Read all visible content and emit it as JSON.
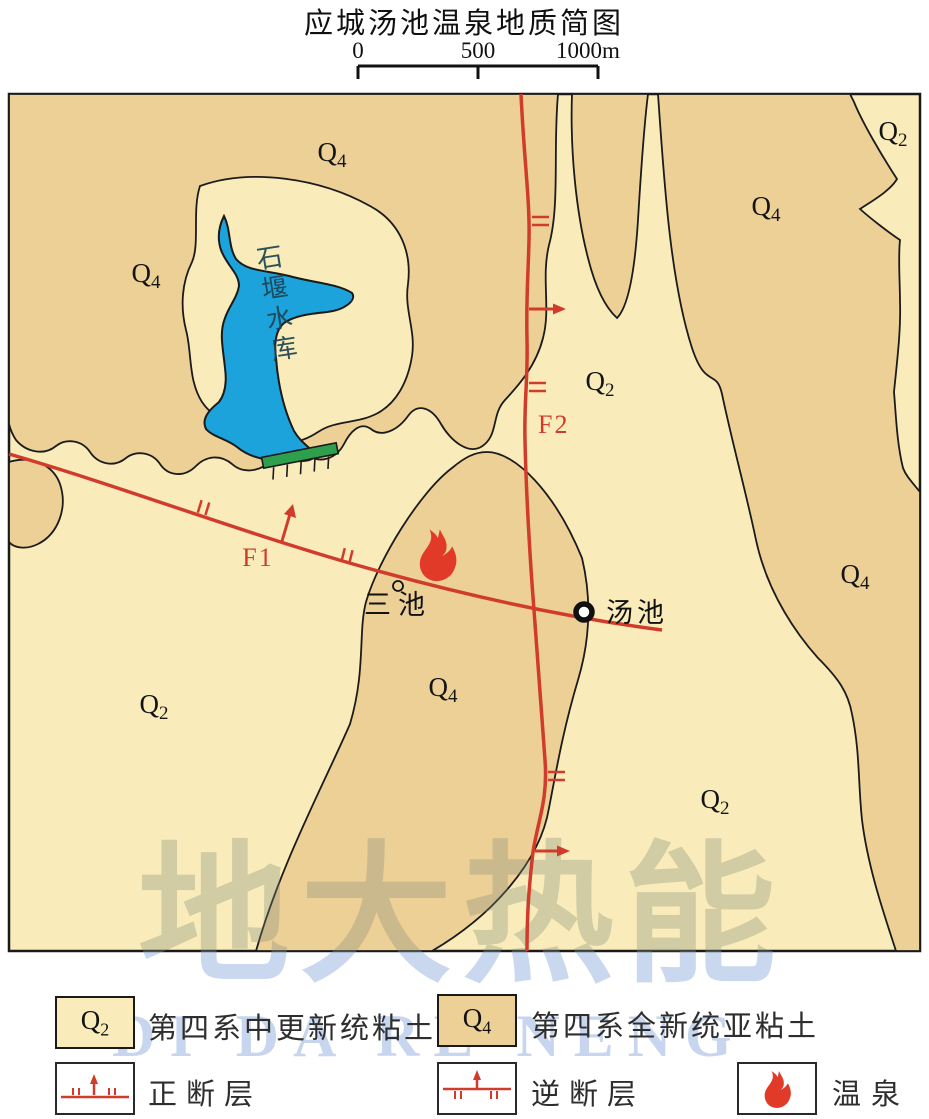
{
  "title": "应城汤池温泉地质简图",
  "scale_bar": {
    "tick_labels": [
      "0",
      "500",
      "1000m"
    ]
  },
  "map": {
    "region_labels": [
      {
        "main": "Q",
        "sub": "4"
      },
      {
        "main": "Q",
        "sub": "4"
      },
      {
        "main": "Q",
        "sub": "2"
      },
      {
        "main": "Q",
        "sub": "4"
      },
      {
        "main": "Q",
        "sub": "2"
      },
      {
        "main": "Q",
        "sub": "4"
      },
      {
        "main": "Q",
        "sub": "2"
      },
      {
        "main": "Q",
        "sub": "4"
      },
      {
        "main": "Q",
        "sub": "2"
      }
    ],
    "faults": {
      "f1": "F1",
      "f2": "F2"
    },
    "reservoir_label": "石堰水库",
    "places": {
      "sanchi": "三池",
      "tangchi": "汤池"
    }
  },
  "watermark": {
    "cn": "地大热能",
    "en": "DI DA RE NENG"
  },
  "legend": {
    "units": [
      {
        "symbol_main": "Q",
        "symbol_sub": "2",
        "label": "第四系中更新统粘土"
      },
      {
        "symbol_main": "Q",
        "symbol_sub": "4",
        "label": "第四系全新统亚粘土"
      }
    ],
    "fault_normal_label": "正断层",
    "fault_reverse_label": "逆断层",
    "hot_spring_label": "温泉"
  },
  "colors": {
    "q2": "#F9ECBA",
    "q4": "#EDD096",
    "water": "#1CA3DC",
    "dam_green": "#2E9F4C",
    "fault_red": "#D13B2B",
    "flame_red": "#E23A28"
  }
}
